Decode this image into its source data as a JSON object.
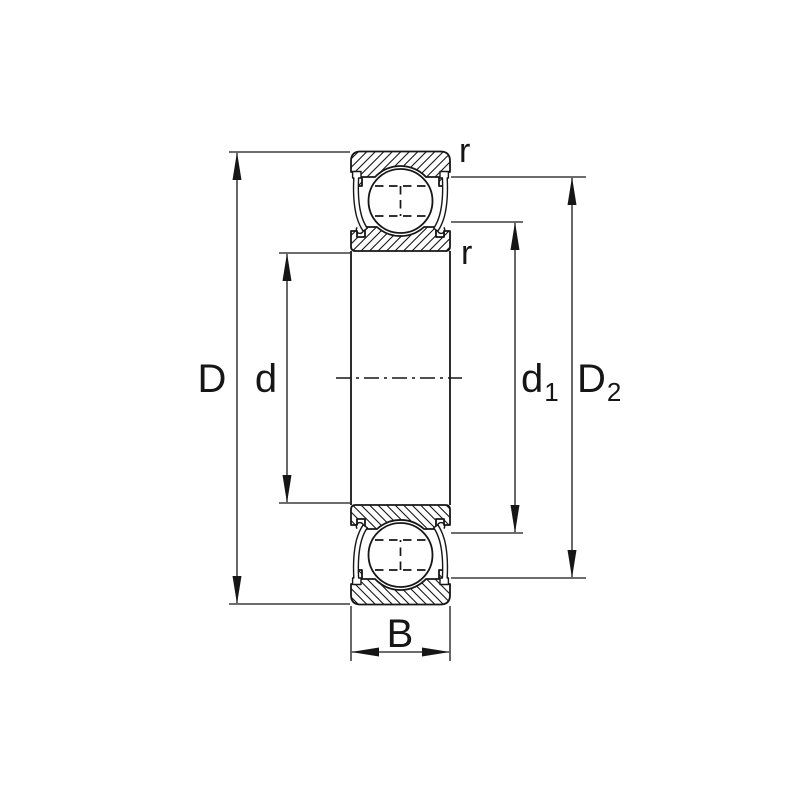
{
  "diagram": {
    "type": "deep-groove-ball-bearing-cross-section",
    "colors": {
      "line": "#161616",
      "background": "#ffffff"
    },
    "labels": {
      "outer_diameter": {
        "main": "D",
        "sub": ""
      },
      "bore_diameter": {
        "main": "d",
        "sub": ""
      },
      "shield_diameter": {
        "main": "d",
        "sub": "1"
      },
      "recess_diameter": {
        "main": "D",
        "sub": "2"
      },
      "width": {
        "main": "B",
        "sub": ""
      },
      "chamfer_outer": "r",
      "chamfer_inner": "r"
    }
  }
}
